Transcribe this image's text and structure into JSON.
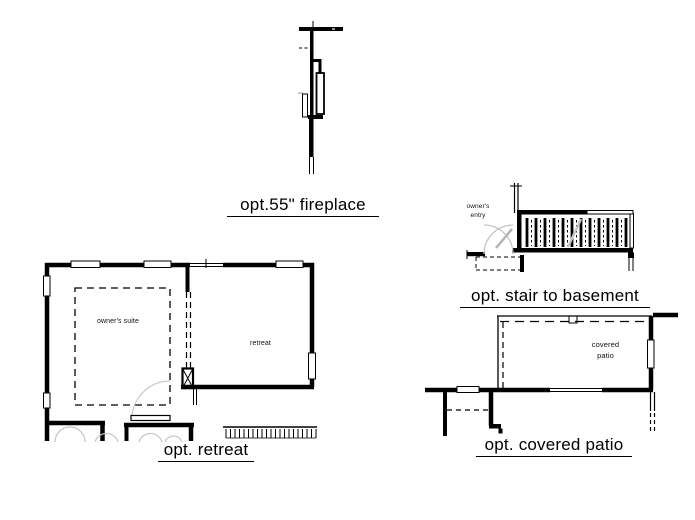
{
  "sheet": {
    "background": "#ffffff",
    "ink": "#000000",
    "swing_gray": "#c4c4c4"
  },
  "fireplace": {
    "caption": "opt.55\" fireplace"
  },
  "stair": {
    "caption": "opt. stair to basement",
    "entry_label": "owner's\nentry"
  },
  "retreat": {
    "caption": "opt. retreat",
    "suite_label": "owner's suite",
    "room_label": "retreat"
  },
  "patio": {
    "caption": "opt. covered patio",
    "room_label": "covered\npatio"
  }
}
